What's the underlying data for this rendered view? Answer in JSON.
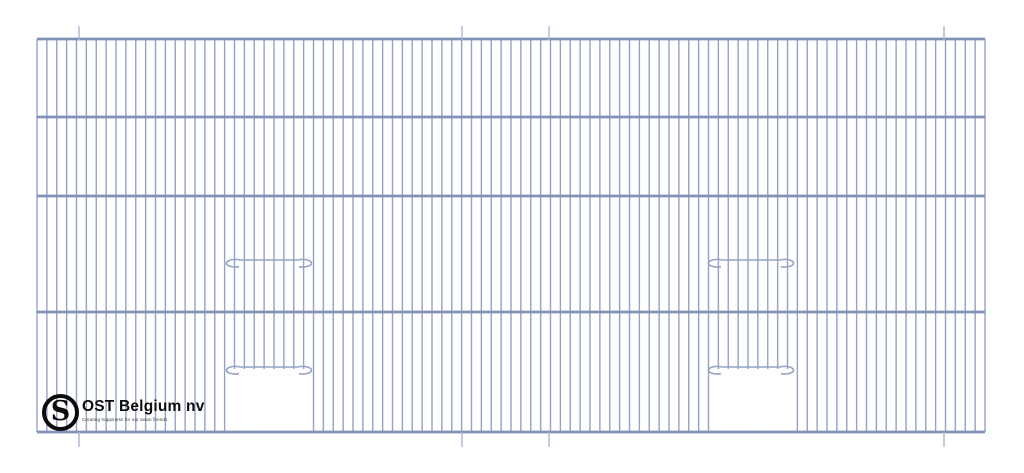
{
  "page": {
    "background": "#ffffff",
    "description": "Technical line drawing of a wire bird-cage front panel with two sliding door openings"
  },
  "logo": {
    "monogram": "S",
    "company": "OST Belgium nv",
    "tagline": "Creating happiness for our avian friends."
  },
  "drawing": {
    "colors": {
      "wire": "#94a3c4",
      "rail": "#8191b7",
      "tick": "#a9b5d1",
      "opening_fill": "#ffffff"
    },
    "panel": {
      "x": 37,
      "y": 39,
      "width": 948,
      "height": 393
    },
    "rails_y": [
      39,
      117,
      196,
      312,
      432
    ],
    "wire_count": 97,
    "wire_stroke": 1.4,
    "rail_stroke": 2.8,
    "ticks": {
      "xs": [
        79,
        462,
        549,
        944
      ],
      "top_y1": 26,
      "top_y2": 40,
      "bottom_y1": 432,
      "bottom_y2": 447,
      "stroke": 1.4
    },
    "doors": [
      {
        "bar_x1": 220,
        "bar_x2": 318,
        "bars_y": [
          260,
          367
        ],
        "opening": {
          "x1": 226.5,
          "x2": 312.5,
          "y1": 369,
          "y2": 430.4
        }
      },
      {
        "bar_x1": 702,
        "bar_x2": 800,
        "bars_y": [
          260,
          367
        ],
        "opening": {
          "x1": 709.5,
          "x2": 795.5,
          "y1": 369,
          "y2": 430.4
        }
      }
    ],
    "hook": {
      "rx": 9,
      "ry": 3.8,
      "drop": 7,
      "inset": 19
    }
  }
}
